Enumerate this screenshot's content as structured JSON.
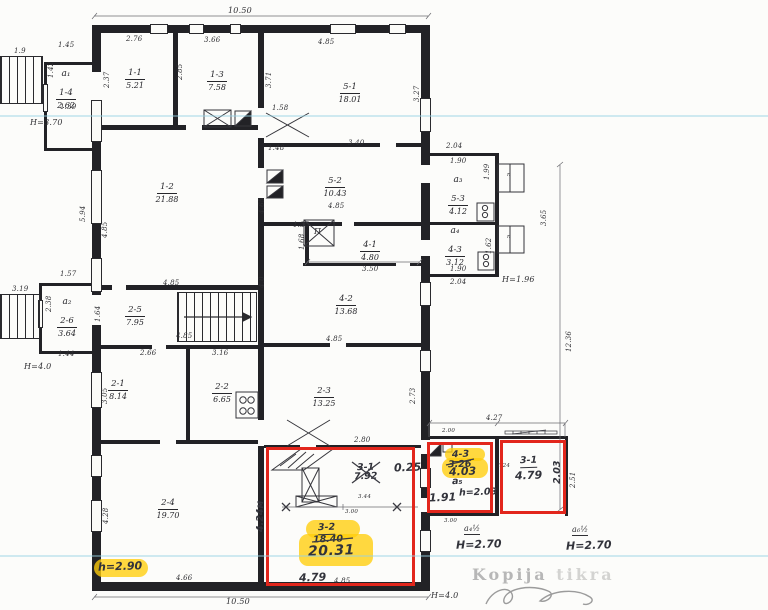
{
  "document": {
    "kind": "scanned architectural floor plan with inspector annotations",
    "watermark": {
      "word1": "Kopija",
      "word2": "tikra"
    }
  },
  "colors": {
    "paper": "#fcfcfa",
    "ink": "#2f2f33",
    "red_marker": "#e2261c",
    "yellow_highlight": "#ffd20a",
    "scanner_line": "#96d2e4",
    "watermark_gray": "#b7b7b7"
  },
  "rooms": [
    {
      "letter": "a₁",
      "num": "1-4",
      "area": "2.62",
      "x": 44,
      "y": 70
    },
    {
      "num": "1-1",
      "area": "5.21",
      "x": 113,
      "y": 60
    },
    {
      "num": "1-3",
      "area": "7.58",
      "x": 195,
      "y": 62
    },
    {
      "num": "5-1",
      "area": "18.01",
      "x": 328,
      "y": 74
    },
    {
      "num": "1-2",
      "area": "21.88",
      "x": 145,
      "y": 174
    },
    {
      "num": "5-2",
      "area": "10.43",
      "x": 313,
      "y": 168
    },
    {
      "letter": "a₃",
      "num": "5-3",
      "area": "4.12",
      "x": 436,
      "y": 176
    },
    {
      "letter": "a₄",
      "num": "4-3",
      "area": "3.12",
      "x": 433,
      "y": 227
    },
    {
      "num": "4-1",
      "area": "4.80",
      "x": 348,
      "y": 232
    },
    {
      "num": "4-2",
      "area": "13.68",
      "x": 324,
      "y": 286
    },
    {
      "num": "2-5",
      "area": "7.95",
      "x": 113,
      "y": 297
    },
    {
      "letter": "a₂",
      "num": "2-6",
      "area": "3.64",
      "x": 45,
      "y": 298
    },
    {
      "num": "2-1",
      "area": "8.14",
      "x": 96,
      "y": 371
    },
    {
      "num": "2-2",
      "area": "6.65",
      "x": 200,
      "y": 374
    },
    {
      "num": "2-3",
      "area": "13.25",
      "x": 302,
      "y": 378
    },
    {
      "num": "2-4",
      "area": "19.70",
      "x": 146,
      "y": 490
    }
  ],
  "labels": [
    {
      "t": "10.50",
      "x": 228,
      "y": 7,
      "c": "d d8"
    },
    {
      "t": "10.50",
      "x": 226,
      "y": 598,
      "c": "d d8"
    },
    {
      "t": "1.45",
      "x": 58,
      "y": 42
    },
    {
      "t": "2.76",
      "x": 126,
      "y": 36
    },
    {
      "t": "3.66",
      "x": 204,
      "y": 37
    },
    {
      "t": "4.85",
      "x": 318,
      "y": 39
    },
    {
      "t": "1.9",
      "x": 14,
      "y": 48
    },
    {
      "t": "1.42",
      "x": 48,
      "y": 78,
      "r": 1
    },
    {
      "t": "1.39",
      "x": 60,
      "y": 104
    },
    {
      "t": "H=3.70",
      "x": 30,
      "y": 119,
      "c": "d d8"
    },
    {
      "t": "2.37",
      "x": 104,
      "y": 88,
      "r": 1
    },
    {
      "t": "2.85",
      "x": 177,
      "y": 80,
      "r": 1
    },
    {
      "t": "3.71",
      "x": 266,
      "y": 88,
      "r": 1
    },
    {
      "t": "3.27",
      "x": 414,
      "y": 102,
      "r": 1
    },
    {
      "t": "5.94",
      "x": 80,
      "y": 222,
      "r": 1
    },
    {
      "t": "4.85",
      "x": 102,
      "y": 238,
      "r": 1
    },
    {
      "t": "1.58",
      "x": 272,
      "y": 105
    },
    {
      "t": "1.48",
      "x": 268,
      "y": 145
    },
    {
      "t": "3.40",
      "x": 348,
      "y": 140
    },
    {
      "t": "2.04",
      "x": 446,
      "y": 143
    },
    {
      "t": "1.90",
      "x": 450,
      "y": 158
    },
    {
      "t": "1.99",
      "x": 484,
      "y": 180,
      "r": 1
    },
    {
      "t": "3.65",
      "x": 541,
      "y": 226,
      "r": 1
    },
    {
      "t": "1.62",
      "x": 486,
      "y": 254,
      "r": 1
    },
    {
      "t": "1.90",
      "x": 450,
      "y": 266
    },
    {
      "t": "2.04",
      "x": 450,
      "y": 279
    },
    {
      "t": "H=1.96",
      "x": 502,
      "y": 276,
      "c": "d d8"
    },
    {
      "t": "1.35",
      "x": 293,
      "y": 222
    },
    {
      "t": "1.68",
      "x": 299,
      "y": 250,
      "r": 1
    },
    {
      "t": "П",
      "x": 314,
      "y": 228,
      "c": "d d8"
    },
    {
      "t": "п",
      "x": 507,
      "y": 173,
      "c": "d d6"
    },
    {
      "t": "п",
      "x": 507,
      "y": 235,
      "c": "d d6"
    },
    {
      "t": "3.50",
      "x": 362,
      "y": 266
    },
    {
      "t": "4.85",
      "x": 328,
      "y": 203
    },
    {
      "t": "4.85",
      "x": 326,
      "y": 336
    },
    {
      "t": "4.85",
      "x": 163,
      "y": 280
    },
    {
      "t": "4.85",
      "x": 176,
      "y": 333
    },
    {
      "t": "3.19",
      "x": 12,
      "y": 286
    },
    {
      "t": "2.38",
      "x": 46,
      "y": 312,
      "r": 1
    },
    {
      "t": "H=4.0",
      "x": 24,
      "y": 363,
      "c": "d d8"
    },
    {
      "t": "1.57",
      "x": 60,
      "y": 271
    },
    {
      "t": "1.44",
      "x": 58,
      "y": 351
    },
    {
      "t": "1.64",
      "x": 95,
      "y": 322,
      "r": 1
    },
    {
      "t": "2.66",
      "x": 140,
      "y": 350
    },
    {
      "t": "3.16",
      "x": 212,
      "y": 350
    },
    {
      "t": "3.05",
      "x": 102,
      "y": 404,
      "r": 1
    },
    {
      "t": "4.28",
      "x": 103,
      "y": 524,
      "r": 1
    },
    {
      "t": "4.66",
      "x": 176,
      "y": 575
    },
    {
      "t": "2.73",
      "x": 410,
      "y": 404,
      "r": 1
    },
    {
      "t": "4.65",
      "x": 259,
      "y": 214,
      "r": 1
    },
    {
      "t": "4.0",
      "x": 259,
      "y": 288,
      "r": 1
    },
    {
      "t": "2.80",
      "x": 354,
      "y": 437
    },
    {
      "t": "3.44",
      "x": 358,
      "y": 495,
      "c": "d d6"
    },
    {
      "t": "3.00",
      "x": 345,
      "y": 510,
      "c": "d d6"
    },
    {
      "t": "4.85",
      "x": 334,
      "y": 578
    },
    {
      "t": "4.27",
      "x": 486,
      "y": 415
    },
    {
      "t": "2.00",
      "x": 442,
      "y": 429,
      "c": "d d6"
    },
    {
      "t": "1.24",
      "x": 497,
      "y": 464,
      "c": "d d6"
    },
    {
      "t": "2.51",
      "x": 570,
      "y": 488,
      "r": 1
    },
    {
      "t": "3.00",
      "x": 444,
      "y": 519,
      "c": "d d6"
    },
    {
      "t": "12.36",
      "x": 566,
      "y": 352,
      "r": 1
    },
    {
      "t": "a₄½",
      "x": 464,
      "y": 525,
      "c": "d d8 u"
    },
    {
      "t": "a₆½",
      "x": 572,
      "y": 526,
      "c": "d d8 u"
    },
    {
      "t": "H=4.0",
      "x": 431,
      "y": 592,
      "c": "d d8"
    }
  ],
  "handwritten": [
    {
      "t": "3-1",
      "x": 357,
      "y": 463
    },
    {
      "t": "7.92",
      "x": 354,
      "y": 472
    },
    {
      "t": "0.25",
      "x": 394,
      "y": 462,
      "c": "hw hw2"
    },
    {
      "t": "3-2",
      "x": 318,
      "y": 523,
      "c": "hw hwu"
    },
    {
      "t": "18.40",
      "x": 313,
      "y": 535
    },
    {
      "t": "20.31",
      "x": 308,
      "y": 544,
      "c": "hw hwbig"
    },
    {
      "t": "4.79",
      "x": 299,
      "y": 572,
      "c": "hw hw2"
    },
    {
      "t": "4.24м",
      "x": 256,
      "y": 532,
      "c": "hw hwr"
    },
    {
      "t": "4-3",
      "x": 452,
      "y": 450,
      "c": "hw hwu"
    },
    {
      "t": "3.26",
      "x": 448,
      "y": 460
    },
    {
      "t": "4.03",
      "x": 449,
      "y": 466,
      "c": "hw hw2"
    },
    {
      "t": "a₅",
      "x": 452,
      "y": 477
    },
    {
      "t": "1.91",
      "x": 429,
      "y": 492,
      "c": "hw hw2"
    },
    {
      "t": "h=2.03",
      "x": 459,
      "y": 488
    },
    {
      "t": "3-1",
      "x": 520,
      "y": 456,
      "c": "hw hwu"
    },
    {
      "t": "4.79",
      "x": 515,
      "y": 470,
      "c": "hw hw2"
    },
    {
      "t": "2.03",
      "x": 553,
      "y": 484,
      "c": "hw hwr"
    },
    {
      "t": "H=2.70",
      "x": 456,
      "y": 539,
      "c": "hw hw2"
    },
    {
      "t": "H=2.70",
      "x": 566,
      "y": 540,
      "c": "hw hw2"
    },
    {
      "t": "h=2.90",
      "x": 98,
      "y": 561,
      "c": "hw hw2"
    }
  ]
}
